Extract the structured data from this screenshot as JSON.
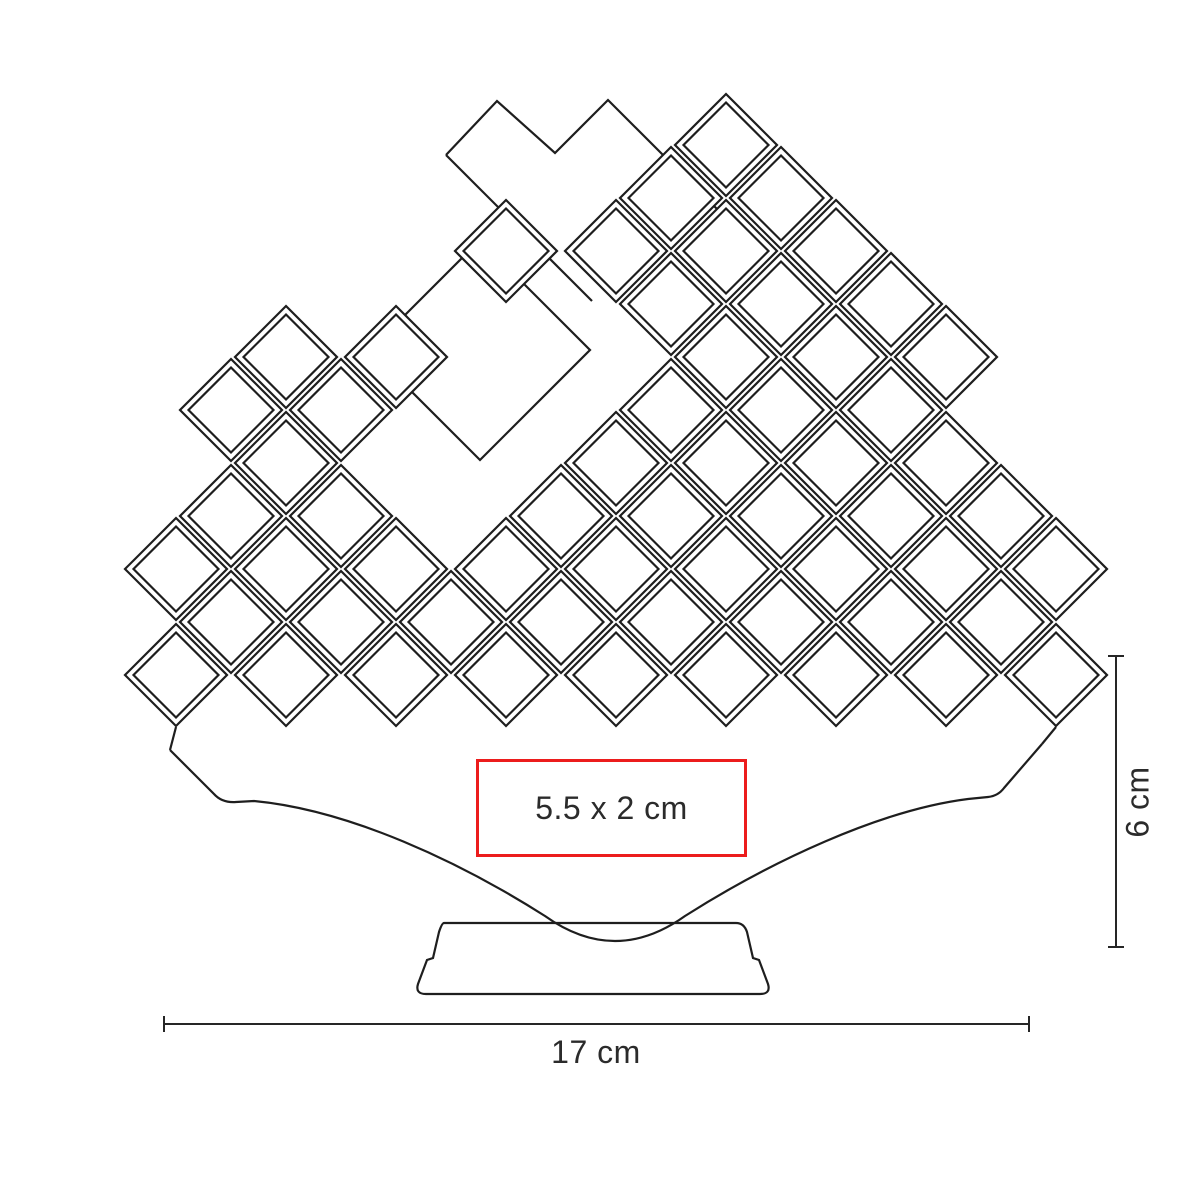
{
  "labels": {
    "imprint_area": "5.5 x 2 cm",
    "width_dimension": "17 cm",
    "height_dimension": "6 cm"
  },
  "colors": {
    "line": "#1e1e1e",
    "dimension_line": "#262626",
    "text": "#2b2b2b",
    "imprint_border": "#ec1c1c",
    "background": "#ffffff"
  },
  "drawing": {
    "stroke_width": 2.2,
    "lattice": {
      "x0": 121,
      "col_step": 55,
      "y0": 145,
      "row_step": 53,
      "outer_half": 51,
      "inner_half": 42.5,
      "cells": [
        [
          11,
          0
        ],
        [
          10,
          1
        ],
        [
          12,
          1
        ],
        [
          7,
          2
        ],
        [
          9,
          2
        ],
        [
          11,
          2
        ],
        [
          13,
          2
        ],
        [
          10,
          3
        ],
        [
          12,
          3
        ],
        [
          14,
          3
        ],
        [
          3,
          4
        ],
        [
          5,
          4
        ],
        [
          11,
          4
        ],
        [
          13,
          4
        ],
        [
          15,
          4
        ],
        [
          2,
          5
        ],
        [
          4,
          5
        ],
        [
          10,
          5
        ],
        [
          12,
          5
        ],
        [
          14,
          5
        ],
        [
          3,
          6
        ],
        [
          9,
          6
        ],
        [
          11,
          6
        ],
        [
          13,
          6
        ],
        [
          15,
          6
        ],
        [
          2,
          7
        ],
        [
          4,
          7
        ],
        [
          8,
          7
        ],
        [
          10,
          7
        ],
        [
          12,
          7
        ],
        [
          14,
          7
        ],
        [
          16,
          7
        ],
        [
          1,
          8
        ],
        [
          3,
          8
        ],
        [
          5,
          8
        ],
        [
          7,
          8
        ],
        [
          9,
          8
        ],
        [
          11,
          8
        ],
        [
          13,
          8
        ],
        [
          15,
          8
        ],
        [
          17,
          8
        ],
        [
          2,
          9
        ],
        [
          4,
          9
        ],
        [
          6,
          9
        ],
        [
          8,
          9
        ],
        [
          10,
          9
        ],
        [
          12,
          9
        ],
        [
          14,
          9
        ],
        [
          16,
          9
        ],
        [
          1,
          10
        ],
        [
          3,
          10
        ],
        [
          5,
          10
        ],
        [
          7,
          10
        ],
        [
          9,
          10
        ],
        [
          11,
          10
        ],
        [
          13,
          10
        ],
        [
          15,
          10
        ],
        [
          17,
          10
        ]
      ]
    },
    "background_paths": {
      "top_silhouette": "M 446,155 L 497,101 L 555,153 L 608,100 L 742,234",
      "left_band_edge": "M 446,155 L 592,301",
      "center_void_diamond": "M 480,240 L 590,350 L 480,460 L 370,350 Z"
    },
    "fan_path": "M 170,750 L 214,794 Q 222,803 236,802 L 254,801 C 350,810 460,862 545,916 Q 615,966 685,916 C 770,862 880,810 968,799 L 988,797 Q 998,796 1004,788 L 1042,744",
    "stand_path": "M 444,923 L 736,923 Q 744,923 747,932 L 753,958 L 759,960 L 768,984 Q 771,994 760,994 L 426,994 Q 415,994 418,984 L 427,960 L 433,958 L 439,932 Q 442,923 444,923 Z",
    "connector_paths": {
      "left": "M 170,750 L 176,727",
      "right": "M 1042,744 L 1056,727"
    }
  }
}
